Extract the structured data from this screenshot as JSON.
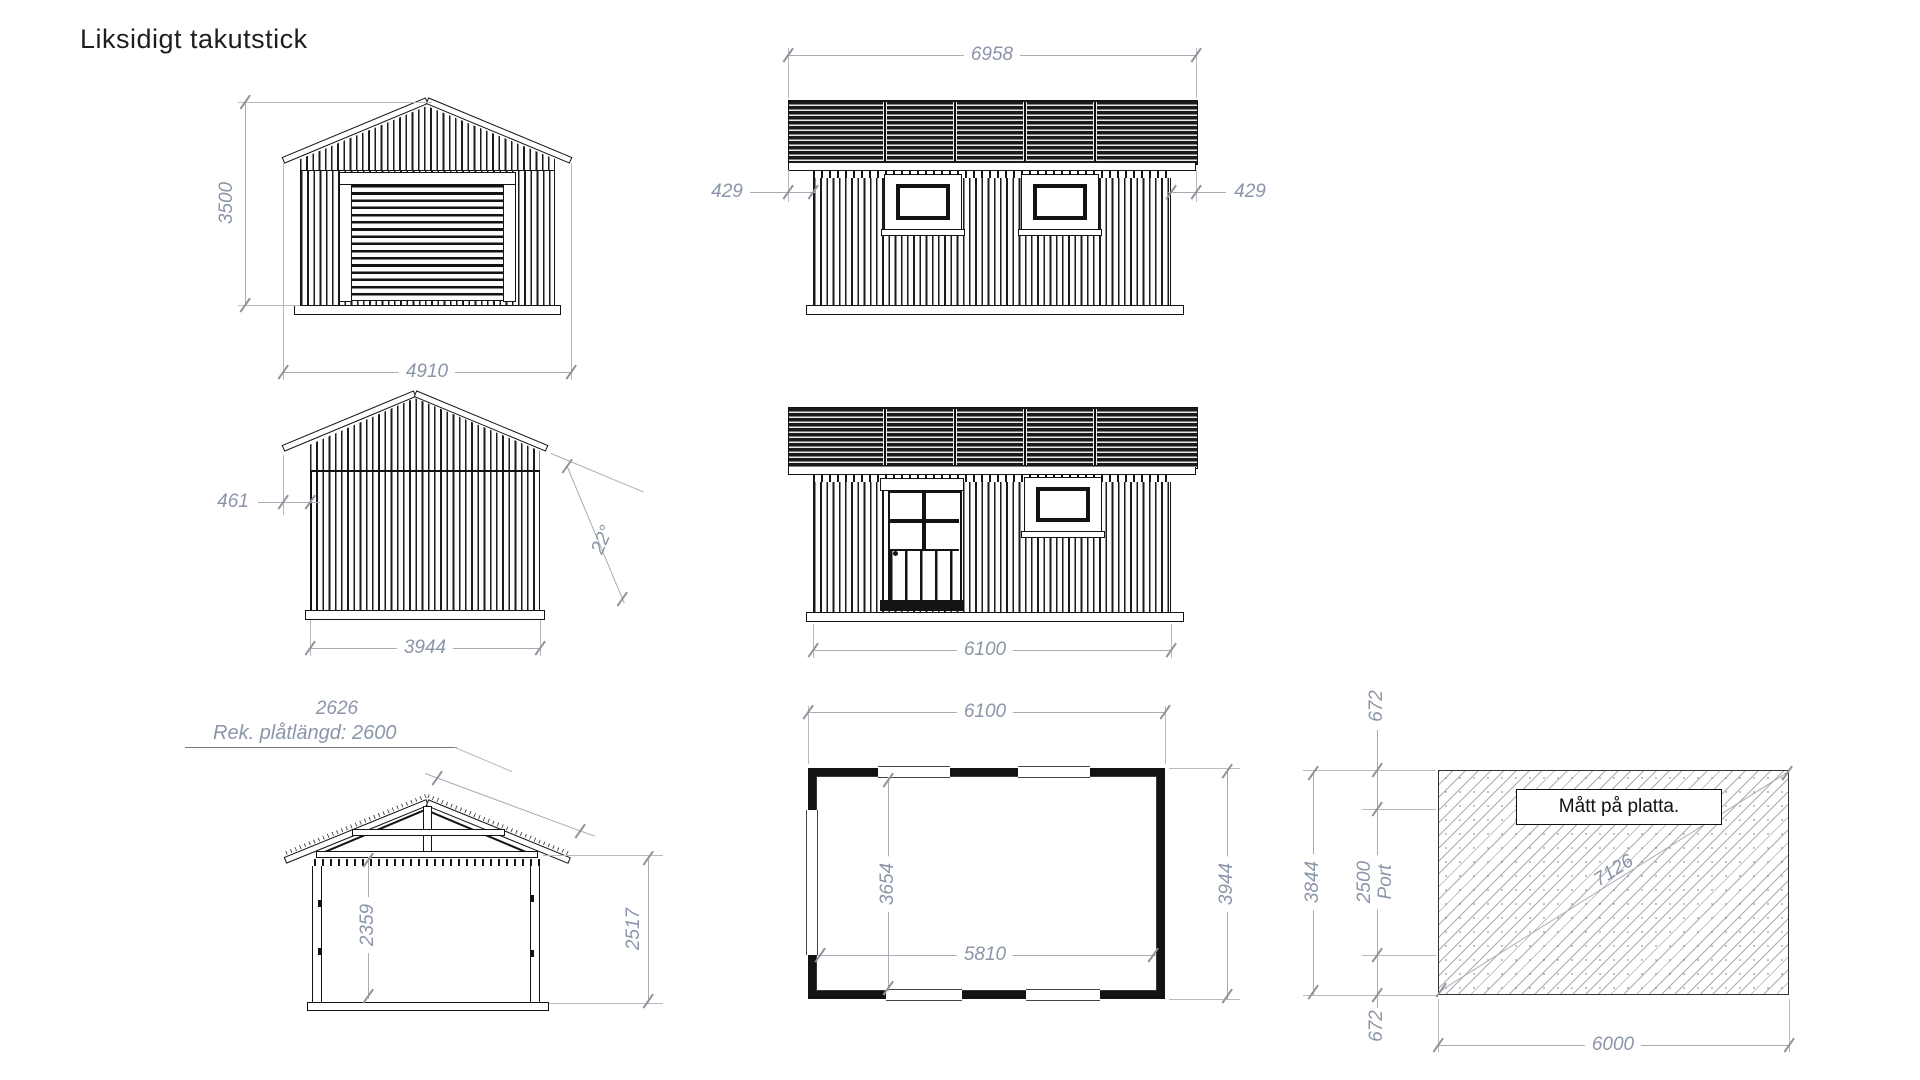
{
  "title": "Liksidigt takutstick",
  "views": {
    "front_elevation": {
      "height_mm": "3500",
      "roof_width_mm": "4910"
    },
    "side_elevation_rear": {
      "roof_length_mm": "6958",
      "overhang_left_mm": "429",
      "overhang_right_mm": "429"
    },
    "gable_elevation": {
      "overhang_mm": "461",
      "wall_width_mm": "3944",
      "roof_angle": "22°"
    },
    "side_elevation_front": {
      "wall_length_mm": "6100"
    },
    "section": {
      "roof_slope_mm": "2626",
      "sheet_note": "Rek. plåtlängd: 2600",
      "interior_height_mm": "2359",
      "wall_height_mm": "2517"
    },
    "floor_plan": {
      "outer_length_mm": "6100",
      "inner_width_mm": "3654",
      "inner_length_mm": "5810",
      "outer_width_mm": "3944"
    },
    "foundation": {
      "label": "Mått på platta.",
      "top_offset_mm": "672",
      "total_width_mm": "3844",
      "port_width_mm": "2500",
      "port_label": "Port",
      "bottom_offset_mm": "672",
      "diagonal_mm": "7126",
      "length_mm": "6000"
    }
  }
}
